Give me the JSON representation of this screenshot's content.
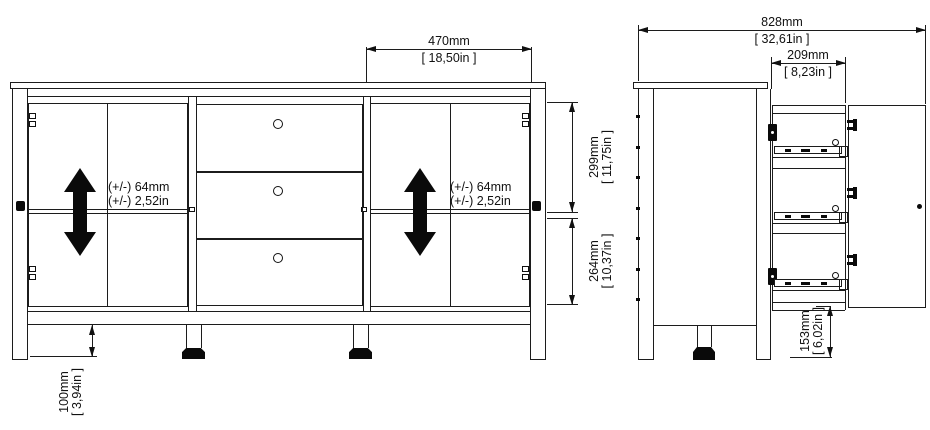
{
  "drawing": {
    "type": "furniture-assembly-dimension-diagram",
    "subject": "sideboard with 2 door compartments, 3 center drawers, adjustable shelves"
  },
  "front_view": {
    "door_section_width": {
      "mm": "470mm",
      "inches": "[ 18,50in ]"
    },
    "upper_compartment_height": {
      "mm": "299mm",
      "inches": "[ 11,75in ]"
    },
    "lower_compartment_height": {
      "mm": "264mm",
      "inches": "[ 10,37in ]"
    },
    "leg_height": {
      "mm": "100mm",
      "inches": "[ 3,94in ]"
    },
    "shelf_adjust_left": {
      "line1": "(+/-) 64mm",
      "line2": "(+/-) 2,52in"
    },
    "shelf_adjust_right": {
      "line1": "(+/-) 64mm",
      "line2": "(+/-) 2,52in"
    }
  },
  "side_view": {
    "total_depth_open": {
      "mm": "828mm",
      "inches": "[ 32,61in ]"
    },
    "drawer_extension": {
      "mm": "209mm",
      "inches": "[ 8,23in ]"
    },
    "floor_clearance": {
      "mm": "153mm",
      "inches": "[ 6,02in ]"
    }
  },
  "colors": {
    "line": "#1c1c1c",
    "solid": "#0a0a0a",
    "background": "#ffffff"
  }
}
